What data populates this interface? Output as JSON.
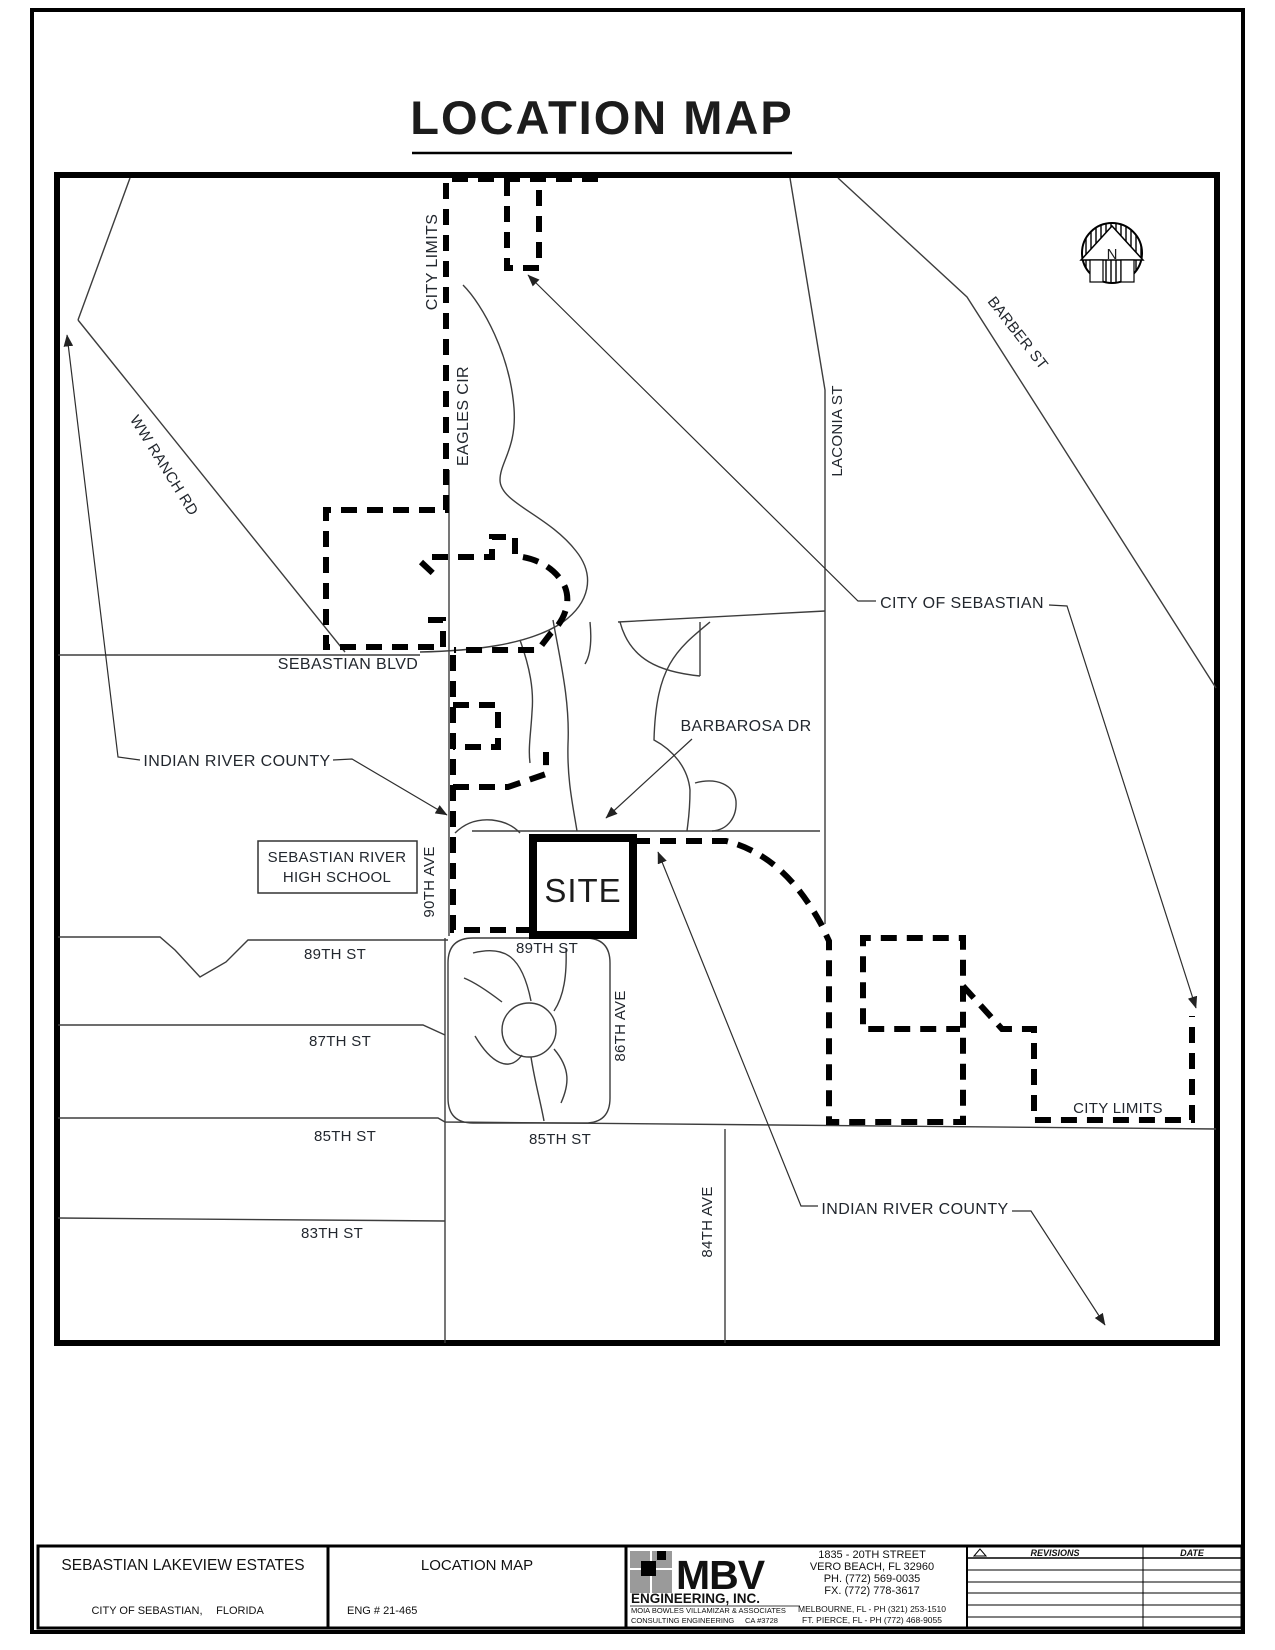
{
  "page": {
    "title": "LOCATION MAP"
  },
  "map": {
    "north": "N",
    "labels": {
      "city_limits_top": "CITY LIMITS",
      "eagles_cir": "EAGLES CIR",
      "ww_ranch_rd": "WW RANCH RD",
      "barber_st": "BARBER ST",
      "laconia_st": "LACONIA ST",
      "city_of_sebastian": "CITY OF SEBASTIAN",
      "sebastian_blvd": "SEBASTIAN BLVD",
      "barbarosa_dr": "BARBAROSA DR",
      "indian_river_county_left": "INDIAN RIVER COUNTY",
      "indian_river_county_bottom": "INDIAN RIVER COUNTY",
      "high_school_line1": "SEBASTIAN RIVER",
      "high_school_line2": "HIGH SCHOOL",
      "ave_90th": "90TH AVE",
      "site": "SITE",
      "st_89th_left": "89TH ST",
      "st_89th_right": "89TH ST",
      "st_87th": "87TH ST",
      "ave_86th": "86TH AVE",
      "st_85th_left": "85TH ST",
      "st_85th_right": "85TH ST",
      "city_limits_right": "CITY LIMITS",
      "st_83th": "83TH ST",
      "ave_84th": "84TH AVE"
    }
  },
  "title_block": {
    "project_name": "SEBASTIAN LAKEVIEW ESTATES",
    "project_city": "CITY OF SEBASTIAN,",
    "project_state": "FLORIDA",
    "sheet_title": "LOCATION MAP",
    "eng_number": "ENG # 21-465",
    "firm": {
      "initials": "MBV",
      "name": "ENGINEERING, INC.",
      "subtitle": "MOIA BOWLES VILLAMIZAR & ASSOCIATES",
      "subtitle2": "CONSULTING ENGINEERING",
      "license": "CA #3728",
      "address_line1": "1835 - 20TH STREET",
      "address_line2": "VERO BEACH, FL 32960",
      "phone": "PH. (772) 569-0035",
      "fax": "FX. (772) 778-3617",
      "office1": "MELBOURNE, FL - PH (321) 253-1510",
      "office2": "FT. PIERCE, FL - PH (772) 468-9055"
    },
    "revisions": {
      "col_revisions": "REVISIONS",
      "col_date": "DATE"
    }
  }
}
